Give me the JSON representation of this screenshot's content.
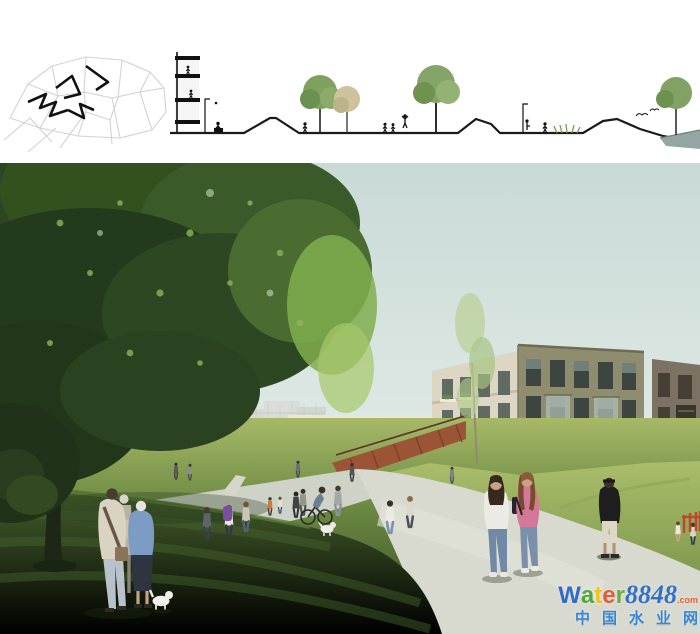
{
  "watermark": {
    "letters": [
      {
        "char": "W",
        "style": "color:#2a66c8"
      },
      {
        "char": "a",
        "style": "color:#49a43b"
      },
      {
        "char": "t",
        "style": "color:#f4c20d"
      },
      {
        "char": "e",
        "style": "color:#e4572e"
      },
      {
        "char": "r",
        "style": "color:#68a83b"
      }
    ],
    "number": {
      "text": "8848",
      "style": "color:#2a6ac8"
    },
    "suffix": {
      "text": ".com",
      "style": "color:#e4572e"
    },
    "cn": {
      "text": "中国水业网",
      "style": "color:#2f82d8"
    }
  },
  "panels": {
    "site_plan": "site-plan key map with bold route marking",
    "section": "landscape section: building, lawn mounds, trees, waterfront",
    "rendering": "park promenade with pedestrians and brick apartment buildings"
  },
  "scene_elements": [
    "large-tree",
    "sky",
    "distant-tower",
    "historic-gabled-building",
    "cream-apartment-building",
    "main-brick-building",
    "right-brick-building",
    "corten-steps",
    "lawn-mound",
    "walking-paths",
    "pedestrians",
    "white-dog",
    "cyclist",
    "watermark"
  ],
  "palette": {
    "sky_top": "#c9dad6",
    "sky_low": "#eef1ed",
    "tree_dark": "#2c4522",
    "tree_mid": "#3b5a2a",
    "tree_light": "#7fae4e",
    "grass_sun": "#a6ba67",
    "grass_mid": "#6d8a43",
    "grass_shadow": "#2c411d",
    "path": "#d8dacf",
    "brick_front": "#8f8d6e",
    "brick_side": "#ddd6c2",
    "brick_right": "#7b7263",
    "building_cream": "#e9e5da",
    "building_historic": "#97866f",
    "building_far": "#d6d9d3",
    "corten": "#9c5436",
    "water": "#93a6a4"
  }
}
